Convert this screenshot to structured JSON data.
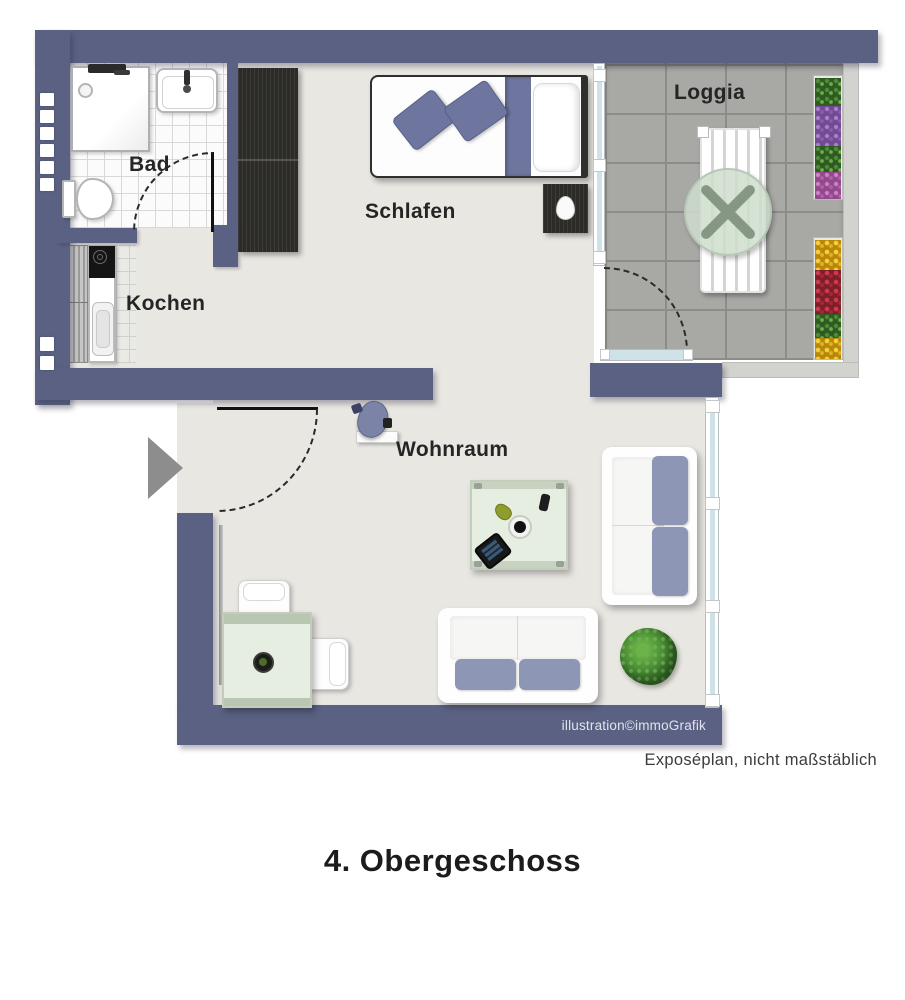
{
  "plan": {
    "title": "4. Obergeschoss",
    "note": "Exposéplan, nicht maßstäblich",
    "credit": "illustration©immoGrafik",
    "rooms": {
      "bad": {
        "label": "Bad"
      },
      "kochen": {
        "label": "Kochen"
      },
      "schlafen": {
        "label": "Schlafen"
      },
      "loggia": {
        "label": "Loggia"
      },
      "wohnraum": {
        "label": "Wohnraum"
      }
    },
    "colors": {
      "wall": "#5a6183",
      "floor": "#e9e7e2",
      "loggia_tile": "#a8a8a5",
      "bed_blue": "#6e76a0",
      "cushion_blue": "#8d96b4",
      "glass_green": "#e6ede1",
      "dark_wood": "#2c2b28",
      "entrance_arrow": "#8d8d8d"
    }
  }
}
